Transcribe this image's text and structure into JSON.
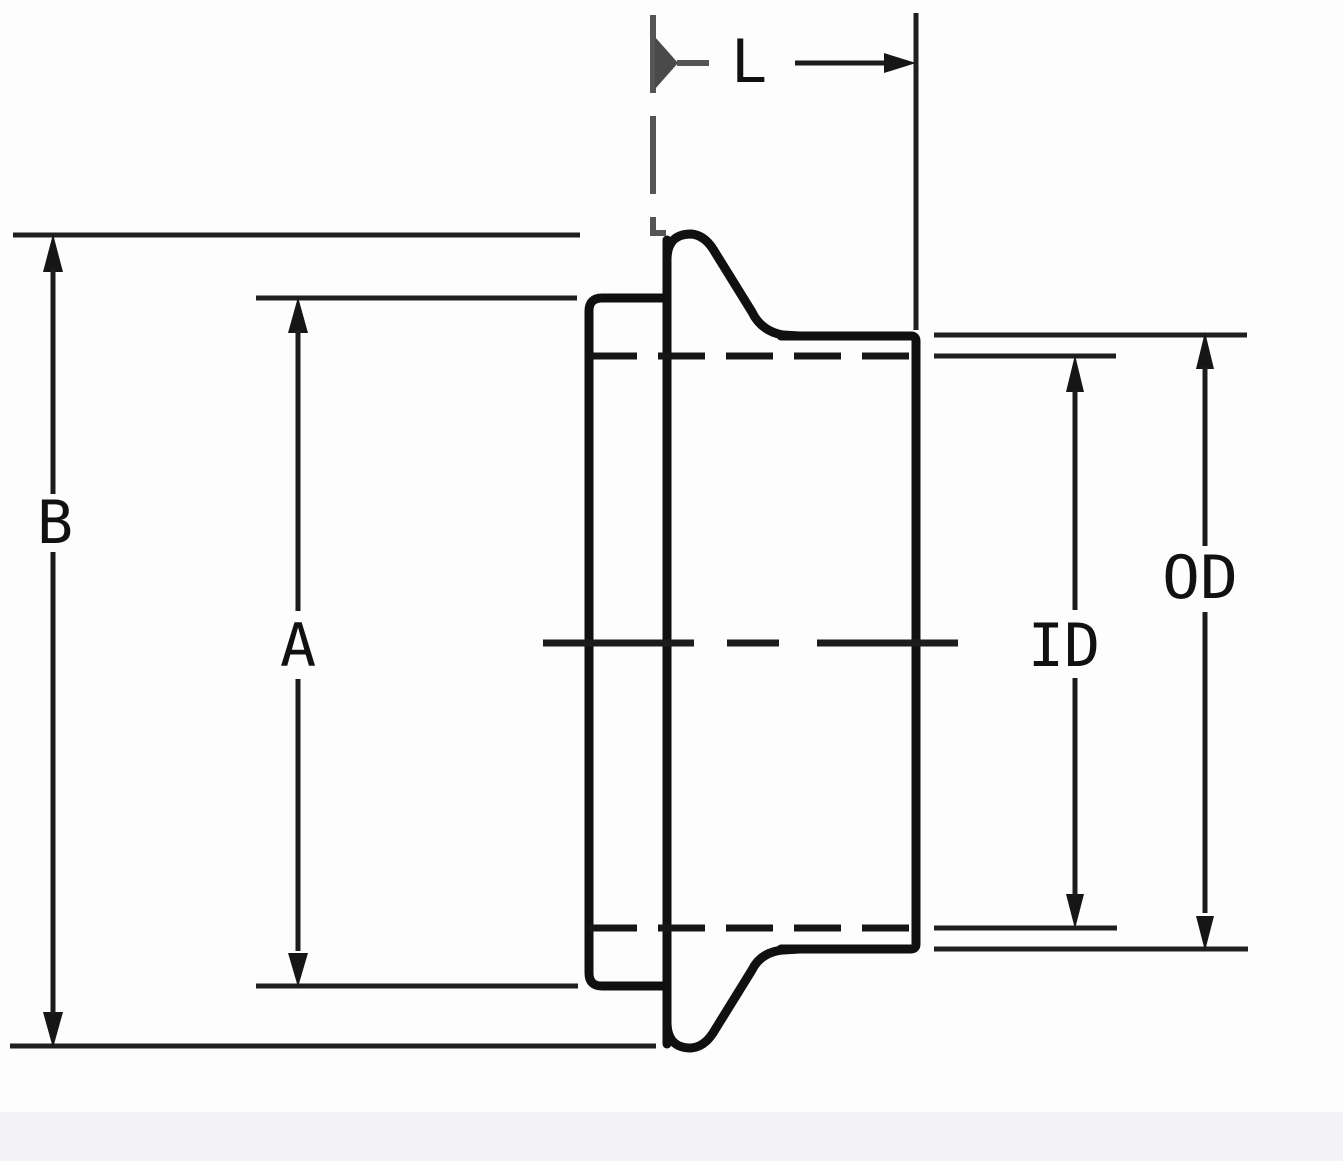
{
  "diagram": {
    "kind": "ferrule-fitting-dimension-drawing",
    "labels": {
      "l": "L",
      "b": "B",
      "a": "A",
      "od": "OD",
      "id": "ID"
    },
    "colors": {
      "outline": "#101010",
      "dimension_lines": "#1c1c1c",
      "muted_arrow": "#4a4a4a",
      "background": "#fdfdfd",
      "bottom_band": "#f3f3f5"
    }
  }
}
